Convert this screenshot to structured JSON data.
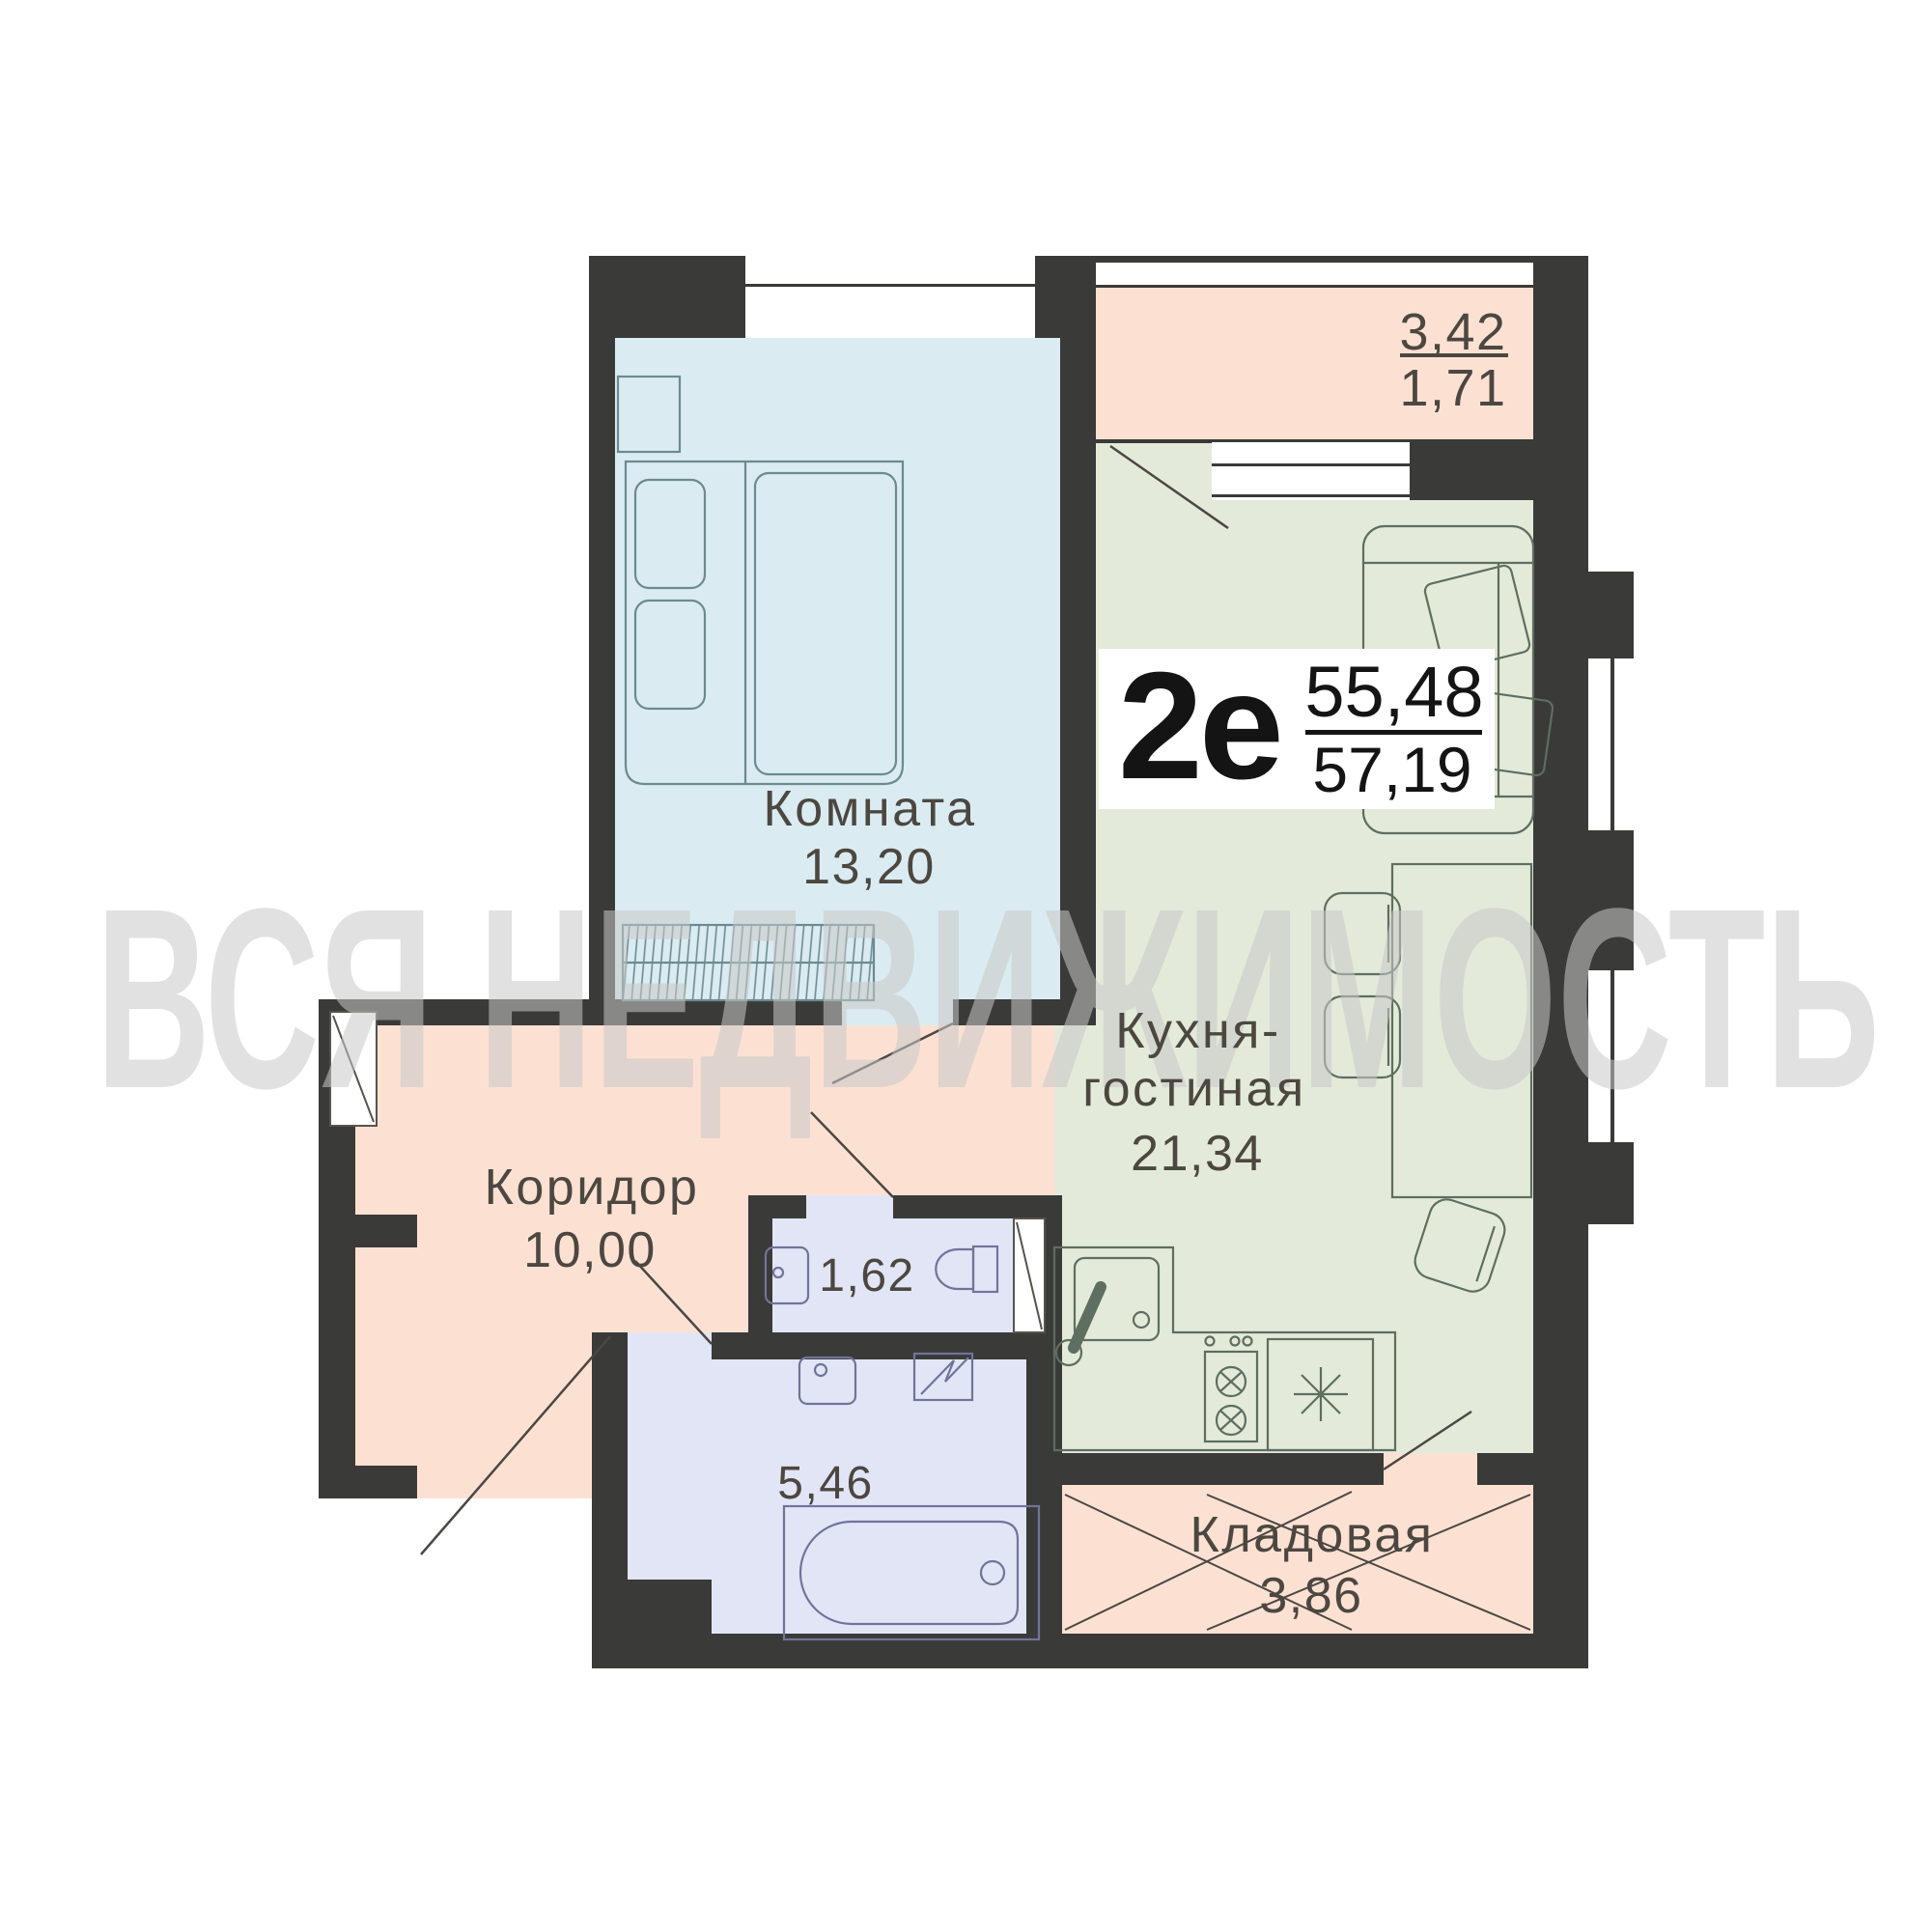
{
  "watermark": {
    "text": "ВСЯ НЕДВИЖИМОСТЬ"
  },
  "unit_badge": {
    "type_label": "2е",
    "area_upper": "55,48",
    "area_lower": "57,19"
  },
  "rooms": {
    "bedroom": {
      "name": "Комната",
      "area": "13,20"
    },
    "kitchen_living": {
      "name_line1": "Кухня-",
      "name_line2": "гостиная",
      "area": "21,34"
    },
    "corridor": {
      "name": "Коридор",
      "area": "10,00"
    },
    "wc": {
      "area": "1,62"
    },
    "bathroom": {
      "area": "5,46"
    },
    "storage": {
      "name": "Кладовая",
      "area": "3,86"
    },
    "balcony": {
      "area_upper": "3,42",
      "area_lower": "1,71"
    }
  },
  "colors": {
    "wall": "#3a3a38",
    "bedroom_fill": "#daecf1",
    "kitchen_fill": "#e3ead9",
    "peach_fill": "#fce1d3",
    "bath_fill": "#e2e5f6",
    "label_text": "#4c4740",
    "badge_bg": "#ffffff",
    "badge_text": "#141414",
    "watermark": "#c9c9c9",
    "furniture_blue": "#6b8a91",
    "furniture_green": "#5e6e60",
    "furniture_violet": "#70749a",
    "door_line": "#4b4742"
  }
}
